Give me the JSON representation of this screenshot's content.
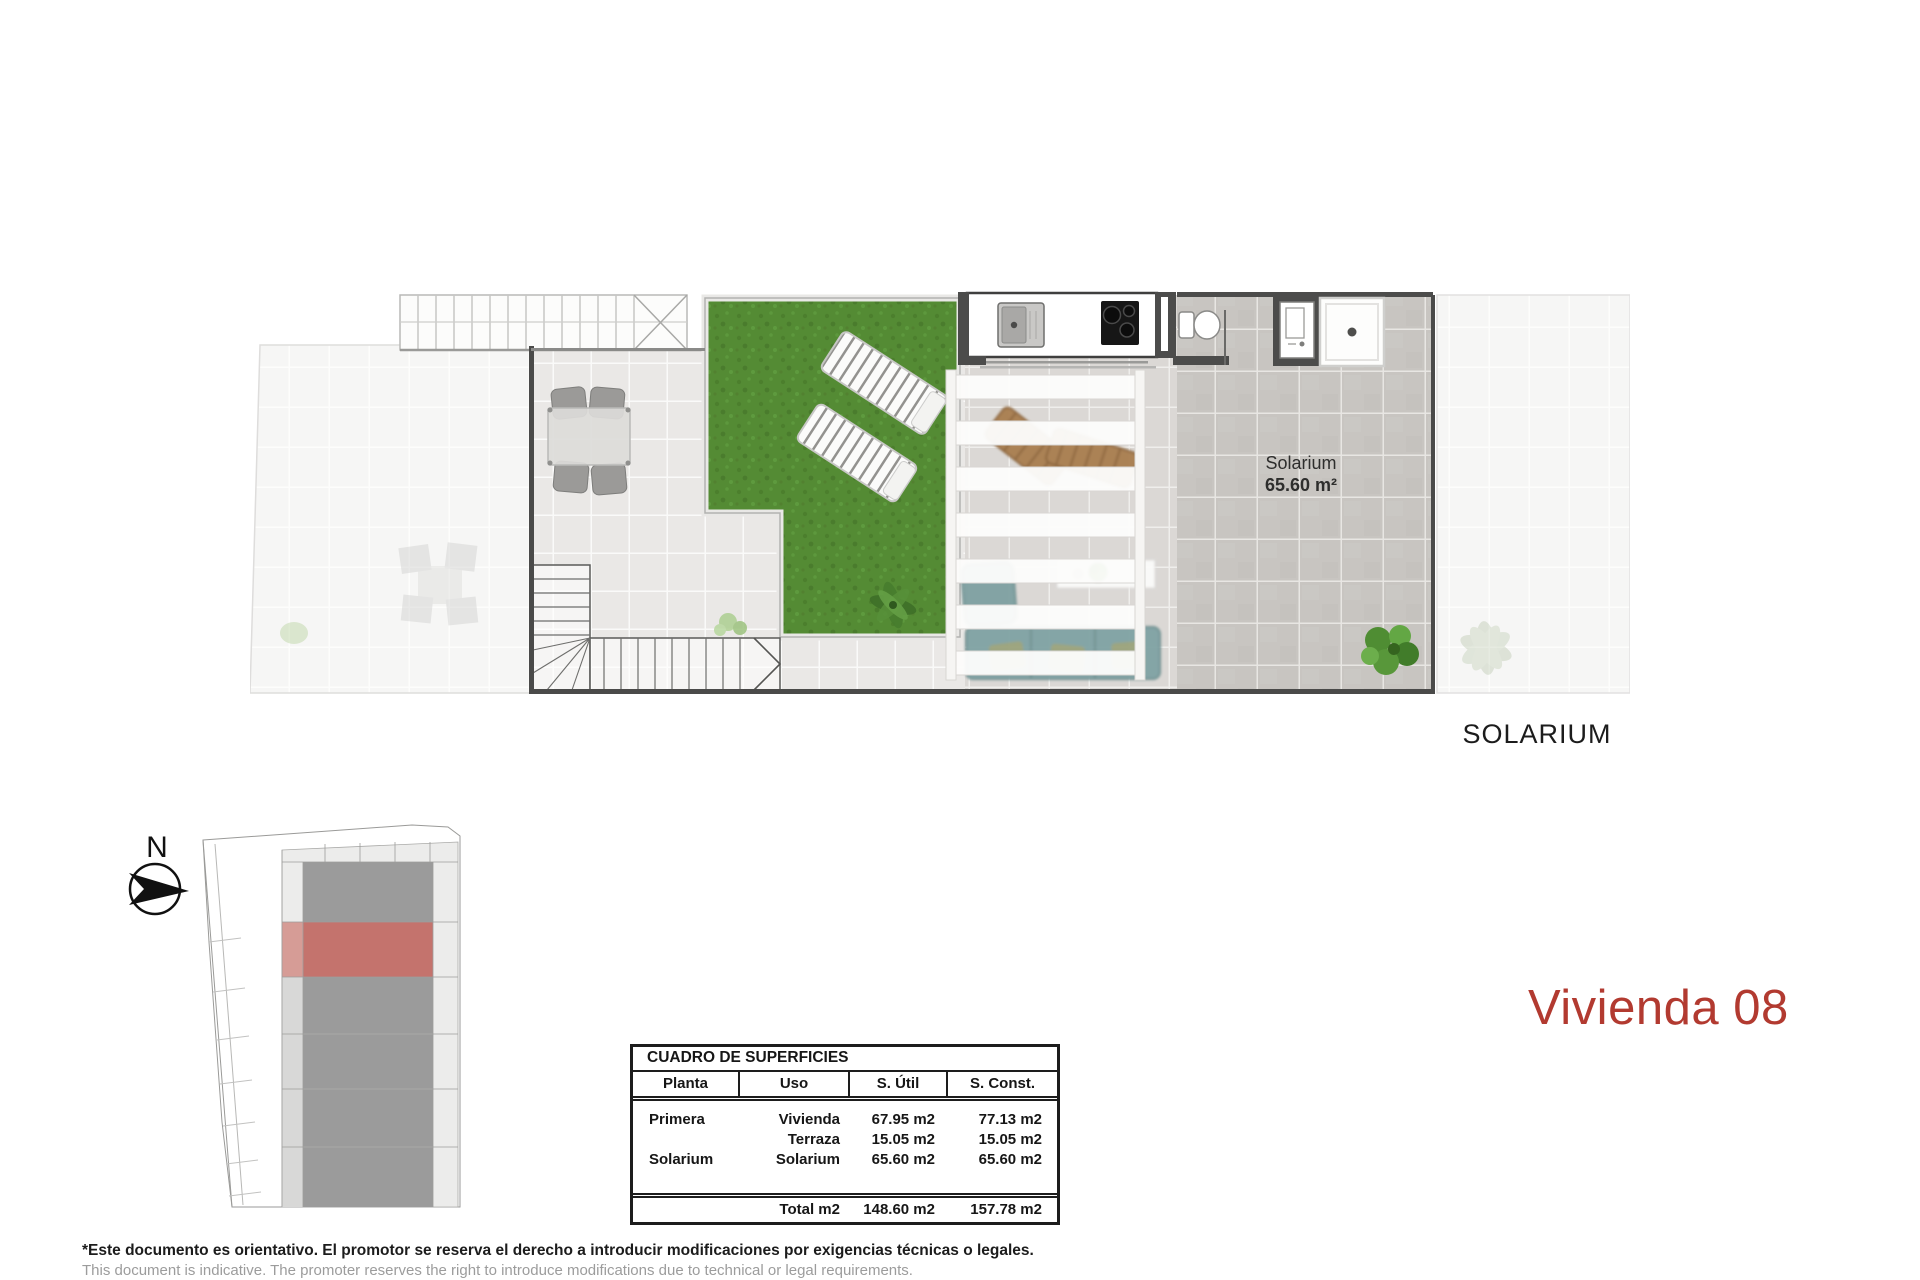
{
  "page": {
    "title": "Vivienda 08",
    "section_label": "SOLARIUM",
    "compass_label": "N"
  },
  "plan": {
    "room_label": "Solarium",
    "room_area": "65.60 m²"
  },
  "surfaces_table": {
    "title": "CUADRO DE SUPERFICIES",
    "headers": [
      "Planta",
      "Uso",
      "S. Útil",
      "S. Const."
    ],
    "rows": [
      [
        "Primera",
        "Vivienda",
        "67.95 m2",
        "77.13 m2"
      ],
      [
        "",
        "Terraza",
        "15.05 m2",
        "15.05 m2"
      ],
      [
        "Solarium",
        "Solarium",
        "65.60 m2",
        "65.60 m2"
      ]
    ],
    "total_row": [
      "",
      "Total m2",
      "148.60 m2",
      "157.78 m2"
    ]
  },
  "disclaimer": {
    "es": "*Este documento es orientativo. El promotor se reserva el derecho a introducir modificaciones por exigencias técnicas o legales.",
    "en": "This document is indicative. The promoter reserves the right to introduce modifications due to technical or legal requirements."
  },
  "colors": {
    "accent": "#b23a30",
    "highlighted_unit": "#c4736d",
    "grass": "#548b34",
    "solarium_tile": "#c8c5c1",
    "wall": "#4a4a49"
  }
}
